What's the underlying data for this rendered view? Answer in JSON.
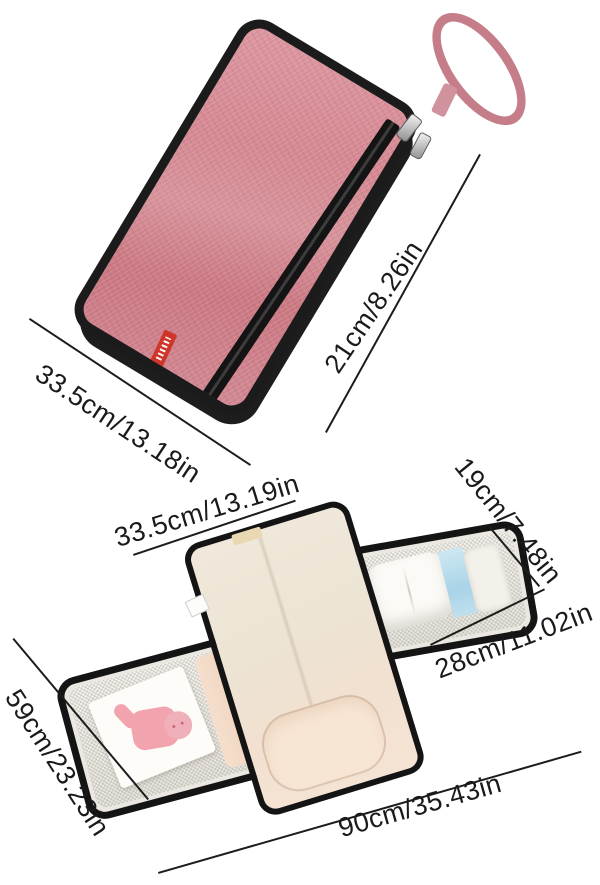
{
  "figure_top": {
    "description": "Folded portable diaper changing pad with wrist strap and zipper",
    "width_label": "33.5cm/13.18in",
    "thickness_label": "21cm/8.26in",
    "colors": {
      "fabric": "#d0828d",
      "trim": "#1b1b1b",
      "strap": "#c57e89",
      "brand_tag": "#cf352a"
    }
  },
  "figure_bottom": {
    "description": "Opened changing pad with mesh storage pockets, diapers, wipes and padded pillow",
    "mat_width_label": "33.5cm/13.19in",
    "pocket_width_label": "19cm/7.48in",
    "wing_width_label": "28cm/11.02in",
    "open_length_label": "59cm/23.23in",
    "open_width_label": "90cm/35.43in",
    "colors": {
      "interior": "#efe8da",
      "pillow": "#f8e6d5",
      "mesh": "#f2f0ea",
      "wipes_pack": "#aed6e8",
      "cartoon_print": "#f1a3ae"
    }
  }
}
